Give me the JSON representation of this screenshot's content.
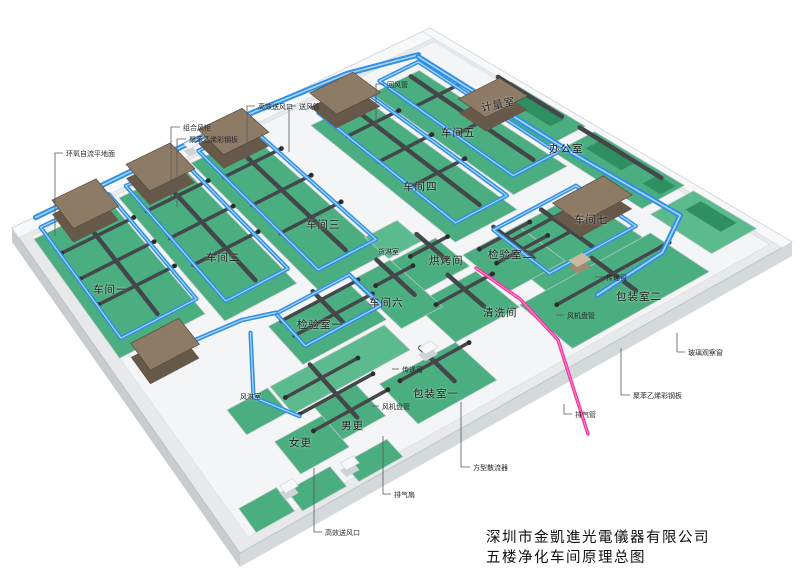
{
  "title_block": {
    "company": "深圳市金凱進光電儀器有限公司",
    "drawing": "五楼净化车间原理总图"
  },
  "rooms": {
    "w1": "车间一",
    "w2": "车间二",
    "w3": "车间三",
    "w4": "车间四",
    "w5": "车间五",
    "w6": "车间六",
    "w7": "车间七",
    "metrology": "计量室",
    "office": "办公室",
    "qc1": "检验室一",
    "qc2": "检验室二",
    "baking": "烘烤间",
    "cleaning": "清洗间",
    "cargo_shower": "货淋室",
    "air_shower": "风淋室",
    "packing1": "包装室一",
    "packing2": "包装室二",
    "men_change": "男更",
    "women_change": "女更"
  },
  "callouts": {
    "ahu": "组合风柜",
    "panel_top": "聚苯乙烯彩钢板",
    "epoxy_floor": "环氧自流平地面",
    "hepa_top": "高效送风口",
    "supply_duct": "送风管",
    "return_duct": "回风管",
    "pass_window_right": "传递窗",
    "fcu_right": "风机盘管",
    "glass_window": "玻璃观察窗",
    "panel_right": "聚苯乙烯彩钢板",
    "exhaust_pipe": "排气管",
    "pass_window_mid": "传递窗",
    "fcu_mid": "风机盘管",
    "square_diffuser": "方型散流器",
    "exhaust_fan": "排气扇",
    "hepa_bottom": "高效送风口"
  },
  "colors": {
    "floor_green": "#4bae80",
    "floor_green_light": "#5cbb8e",
    "teal_strip": "#2e8f63",
    "duct_blue": "#2e8fe4",
    "duct_blue_hi": "#a9d4f7",
    "duct_dark": "#43474a",
    "duct_dark_dot": "#2b2e30",
    "ahu_top": "#8d7b66",
    "ahu_front": "#675949",
    "exhaust_pink": "#ef2f9f",
    "slab_top": "#e7e9eb",
    "slab_side": "#c7ccd0",
    "wall_white": "#f3f5f6",
    "leader": "#5a5a5a"
  }
}
